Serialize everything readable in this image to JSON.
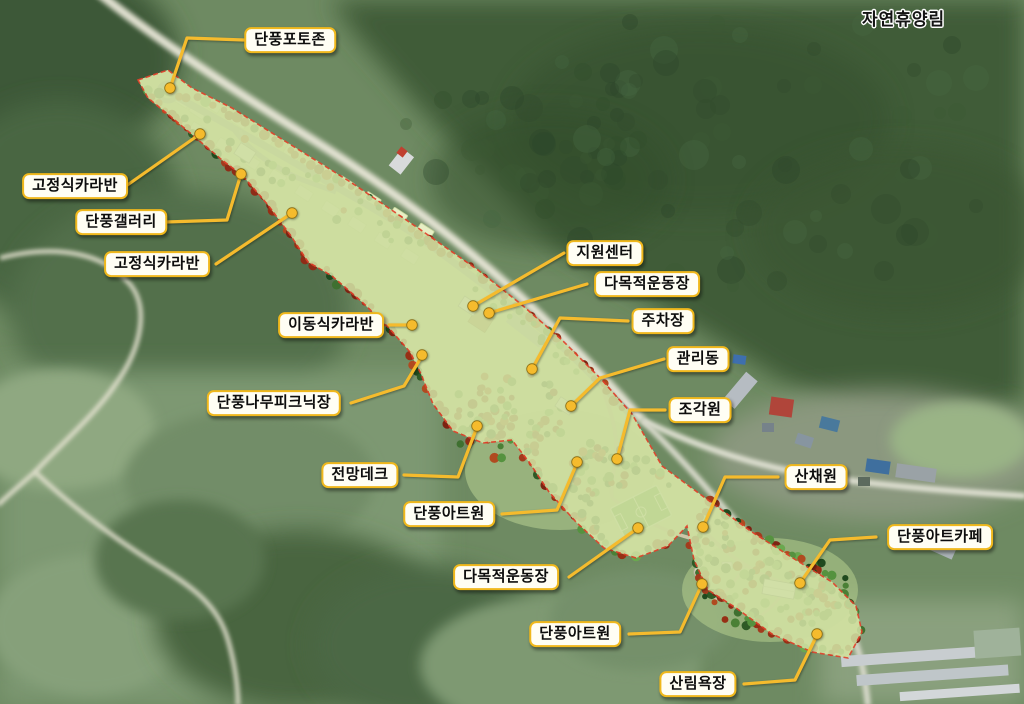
{
  "map": {
    "region_label": "자연휴양림",
    "colors": {
      "accent": "#f5bb2d",
      "label_border": "#f0b81c",
      "label_bg": "#fffef4",
      "park_boundary": "#e2402a"
    },
    "callouts": [
      {
        "id": "photo-zone",
        "label": "단풍포토존",
        "box": {
          "x": 290,
          "y": 40
        },
        "line": [
          [
            244,
            40
          ],
          [
            187,
            38
          ],
          [
            170,
            88
          ]
        ],
        "dot": {
          "x": 170,
          "y": 88
        }
      },
      {
        "id": "fixed-caravan-1",
        "label": "고정식카라반",
        "box": {
          "x": 75,
          "y": 186
        },
        "line": [
          [
            126,
            186
          ],
          [
            200,
            134
          ]
        ],
        "dot": {
          "x": 200,
          "y": 134
        }
      },
      {
        "id": "maple-gallery",
        "label": "단풍갤러리",
        "box": {
          "x": 121,
          "y": 222
        },
        "line": [
          [
            166,
            222
          ],
          [
            227,
            220
          ],
          [
            241,
            174
          ]
        ],
        "dot": {
          "x": 241,
          "y": 174
        }
      },
      {
        "id": "fixed-caravan-2",
        "label": "고정식카라반",
        "box": {
          "x": 157,
          "y": 264
        },
        "line": [
          [
            216,
            264
          ],
          [
            292,
            213
          ]
        ],
        "dot": {
          "x": 292,
          "y": 213
        }
      },
      {
        "id": "mobile-caravan",
        "label": "이동식카라반",
        "box": {
          "x": 331,
          "y": 325
        },
        "line": [
          [
            389,
            325
          ],
          [
            410,
            325
          ]
        ],
        "dot": {
          "x": 412,
          "y": 325
        }
      },
      {
        "id": "support-center",
        "label": "지원센터",
        "box": {
          "x": 605,
          "y": 253
        },
        "line": [
          [
            564,
            253
          ],
          [
            473,
            306
          ]
        ],
        "dot": {
          "x": 473,
          "y": 306
        }
      },
      {
        "id": "multipurpose-field-1",
        "label": "다목적운동장",
        "box": {
          "x": 647,
          "y": 284
        },
        "line": [
          [
            587,
            284
          ],
          [
            489,
            313
          ]
        ],
        "dot": {
          "x": 489,
          "y": 313
        }
      },
      {
        "id": "parking-lot",
        "label": "주차장",
        "box": {
          "x": 663,
          "y": 321
        },
        "line": [
          [
            628,
            321
          ],
          [
            560,
            318
          ],
          [
            532,
            369
          ]
        ],
        "dot": {
          "x": 532,
          "y": 369
        }
      },
      {
        "id": "management-building",
        "label": "관리동",
        "box": {
          "x": 698,
          "y": 359
        },
        "line": [
          [
            664,
            359
          ],
          [
            600,
            378
          ],
          [
            571,
            406
          ]
        ],
        "dot": {
          "x": 571,
          "y": 406
        }
      },
      {
        "id": "sculpture-garden",
        "label": "조각원",
        "box": {
          "x": 700,
          "y": 410
        },
        "line": [
          [
            665,
            410
          ],
          [
            630,
            410
          ],
          [
            617,
            459
          ]
        ],
        "dot": {
          "x": 617,
          "y": 459
        }
      },
      {
        "id": "maple-picnic-area",
        "label": "단풍나무피크닉장",
        "box": {
          "x": 274,
          "y": 403
        },
        "line": [
          [
            351,
            403
          ],
          [
            404,
            386
          ],
          [
            422,
            356
          ]
        ],
        "dot": {
          "x": 422,
          "y": 355
        }
      },
      {
        "id": "observation-deck",
        "label": "전망데크",
        "box": {
          "x": 360,
          "y": 475
        },
        "line": [
          [
            404,
            475
          ],
          [
            458,
            477
          ],
          [
            477,
            427
          ]
        ],
        "dot": {
          "x": 477,
          "y": 426
        }
      },
      {
        "id": "maple-art-garden-1",
        "label": "단풍아트원",
        "box": {
          "x": 449,
          "y": 514
        },
        "line": [
          [
            502,
            514
          ],
          [
            557,
            510
          ],
          [
            577,
            463
          ]
        ],
        "dot": {
          "x": 577,
          "y": 462
        }
      },
      {
        "id": "multipurpose-field-2",
        "label": "다목적운동장",
        "box": {
          "x": 506,
          "y": 577
        },
        "line": [
          [
            569,
            577
          ],
          [
            638,
            528
          ]
        ],
        "dot": {
          "x": 638,
          "y": 528
        }
      },
      {
        "id": "maple-art-garden-2",
        "label": "단풍아트원",
        "box": {
          "x": 575,
          "y": 634
        },
        "line": [
          [
            629,
            634
          ],
          [
            680,
            632
          ],
          [
            702,
            584
          ]
        ],
        "dot": {
          "x": 702,
          "y": 584
        }
      },
      {
        "id": "forest-bathing-area",
        "label": "산림욕장",
        "box": {
          "x": 698,
          "y": 684
        },
        "line": [
          [
            744,
            684
          ],
          [
            795,
            680
          ],
          [
            817,
            635
          ]
        ],
        "dot": {
          "x": 817,
          "y": 634
        }
      },
      {
        "id": "wild-vegetable-garden",
        "label": "산채원",
        "box": {
          "x": 816,
          "y": 477
        },
        "line": [
          [
            778,
            477
          ],
          [
            725,
            477
          ],
          [
            703,
            527
          ]
        ],
        "dot": {
          "x": 703,
          "y": 527
        }
      },
      {
        "id": "maple-art-cafe",
        "label": "단풍아트카페",
        "box": {
          "x": 940,
          "y": 537
        },
        "line": [
          [
            876,
            537
          ],
          [
            830,
            540
          ],
          [
            800,
            583
          ]
        ],
        "dot": {
          "x": 800,
          "y": 583
        }
      }
    ]
  }
}
